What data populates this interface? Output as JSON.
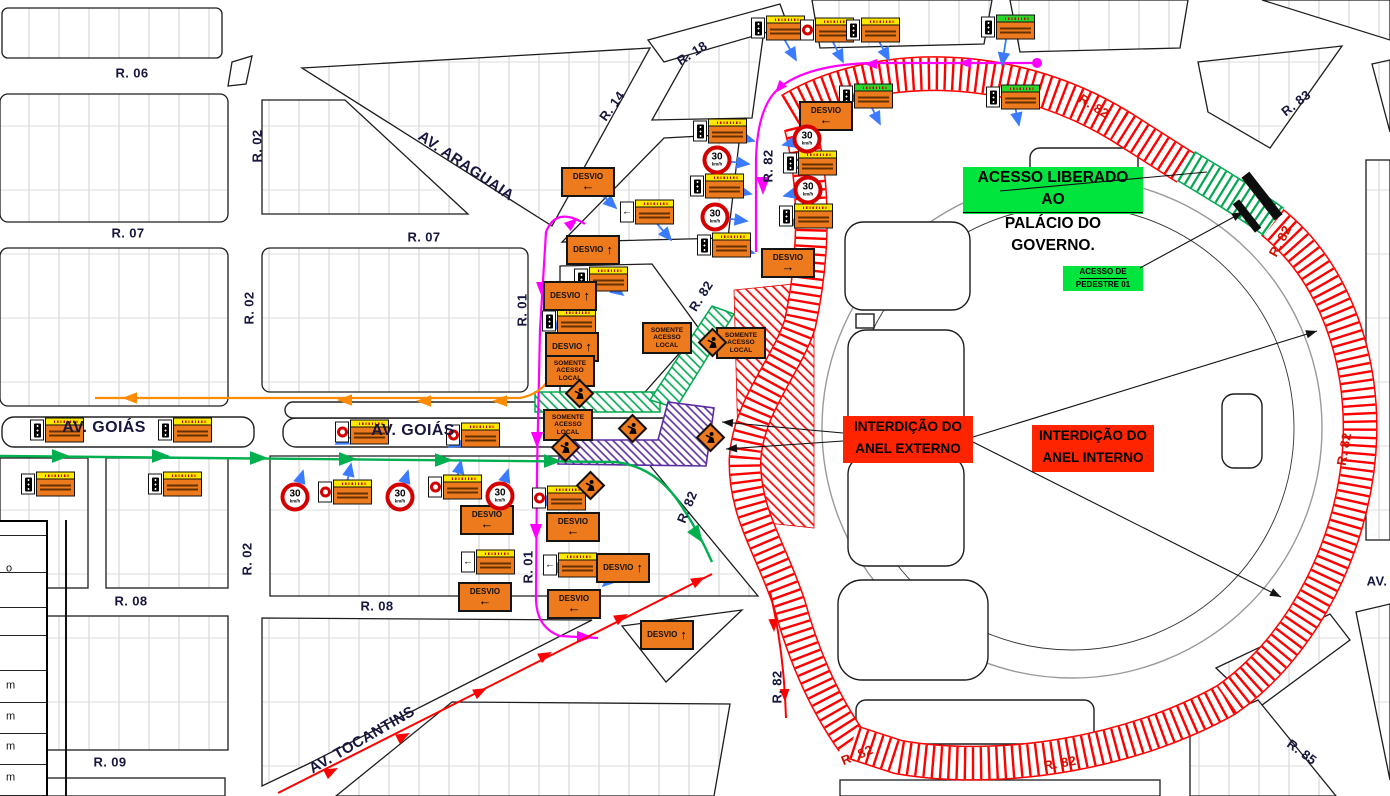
{
  "colors": {
    "closure_red": "#ff2400",
    "hatch_red": "#ff0000",
    "access_green": "#00e53e",
    "hatch_green": "#00a84f",
    "corridor_purple": "#5a2ca0",
    "detour_magenta": "#ff00ff",
    "route_green": "#00b050",
    "route_orange": "#ff8c00",
    "route_red": "#ff0000",
    "leader_blue": "#3b7bff",
    "sign_orange": "#ed7a1c",
    "sign_yellow": "#ffe800",
    "sign_green_header": "#2bd62b",
    "speed_red": "#d40000",
    "label_dark": "#16163f",
    "label_red": "#d01000"
  },
  "callouts": {
    "access_granted": {
      "line1": "ACESSO LIBERADO AO",
      "line2": "PALÁCIO DO GOVERNO."
    },
    "pedestrian_access": {
      "line1": "ACESSO DE",
      "line2": "PEDESTRE 01"
    },
    "outer_ring_closure": {
      "line1": "INTERDIÇÃO DO",
      "line2": "ANEL EXTERNO"
    },
    "inner_ring_closure": {
      "line1": "INTERDIÇÃO DO",
      "line2": "ANEL INTERNO"
    }
  },
  "street_labels": [
    {
      "t": "R. 06",
      "x": 132,
      "y": 73,
      "r": 0
    },
    {
      "t": "R. 02",
      "x": 257,
      "y": 146,
      "r": -90
    },
    {
      "t": "R. 07",
      "x": 128,
      "y": 233,
      "r": 0
    },
    {
      "t": "R. 07",
      "x": 424,
      "y": 237,
      "r": 0
    },
    {
      "t": "AV. ARAGUAIA",
      "x": 466,
      "y": 166,
      "r": 34,
      "s": 15
    },
    {
      "t": "R. 14",
      "x": 612,
      "y": 106,
      "r": -54
    },
    {
      "t": "R. 18",
      "x": 692,
      "y": 53,
      "r": -32
    },
    {
      "t": "R. 82",
      "x": 768,
      "y": 166,
      "r": -90
    },
    {
      "t": "R. 02",
      "x": 249,
      "y": 308,
      "r": -90
    },
    {
      "t": "R. 01",
      "x": 522,
      "y": 310,
      "r": -90
    },
    {
      "t": "AV. GOIÁS",
      "x": 104,
      "y": 428,
      "r": 0,
      "s": 16
    },
    {
      "t": "AV. GOIÁS",
      "x": 413,
      "y": 431,
      "r": 0,
      "s": 16
    },
    {
      "t": "R. 02",
      "x": 247,
      "y": 559,
      "r": -90
    },
    {
      "t": "R. 01",
      "x": 528,
      "y": 567,
      "r": -90
    },
    {
      "t": "R. 82",
      "x": 701,
      "y": 296,
      "r": -58
    },
    {
      "t": "R. 82",
      "x": 687,
      "y": 507,
      "r": -68
    },
    {
      "t": "R. 08",
      "x": 131,
      "y": 601,
      "r": 0
    },
    {
      "t": "R. 08",
      "x": 377,
      "y": 606,
      "r": 0
    },
    {
      "t": "R. 82",
      "x": 777,
      "y": 687,
      "r": -90
    },
    {
      "t": "R. 09",
      "x": 110,
      "y": 762,
      "r": 0
    },
    {
      "t": "AV. TOCANTINS",
      "x": 362,
      "y": 740,
      "r": -30,
      "s": 15
    },
    {
      "t": "R. 83",
      "x": 1296,
      "y": 103,
      "r": -38
    },
    {
      "t": "R. 82",
      "x": 1094,
      "y": 106,
      "r": 32,
      "c": "red"
    },
    {
      "t": "R. 82",
      "x": 1280,
      "y": 241,
      "r": -62,
      "c": "red"
    },
    {
      "t": "R. 82",
      "x": 1344,
      "y": 449,
      "r": -80,
      "c": "red"
    },
    {
      "t": "AV.",
      "x": 1377,
      "y": 581,
      "r": 0
    },
    {
      "t": "R. 82",
      "x": 1060,
      "y": 763,
      "r": -10,
      "c": "red"
    },
    {
      "t": "R. 82",
      "x": 857,
      "y": 755,
      "r": -22,
      "c": "red"
    },
    {
      "t": "R. 85",
      "x": 1302,
      "y": 752,
      "r": 36
    }
  ],
  "signs": {
    "labels": {
      "desvio": "DESVIO",
      "somente": [
        "SOMENTE",
        "ACESSO",
        "LOCAL"
      ],
      "speed": "30",
      "speed_unit": "km/h"
    },
    "items": [
      {
        "t": "atencao",
        "x": 778,
        "y": 28,
        "v": "tl",
        "h": "y",
        "l": [
          18,
          32
        ]
      },
      {
        "t": "atencao",
        "x": 827,
        "y": 30,
        "v": "circle",
        "h": "y",
        "l": [
          16,
          32
        ]
      },
      {
        "t": "atencao",
        "x": 873,
        "y": 30,
        "v": "tl",
        "h": "y",
        "l": [
          16,
          30
        ]
      },
      {
        "t": "atencao",
        "x": 1008,
        "y": 27,
        "v": "tl",
        "h": "g",
        "l": [
          -6,
          38
        ]
      },
      {
        "t": "atencao",
        "x": 1013,
        "y": 97,
        "v": "tl",
        "h": "g",
        "l": [
          6,
          28
        ]
      },
      {
        "t": "atencao",
        "x": 866,
        "y": 96,
        "v": "tl",
        "h": "g",
        "l": [
          14,
          28
        ]
      },
      {
        "t": "atencao",
        "x": 720,
        "y": 131,
        "v": "tl",
        "h": "y",
        "l": [
          34,
          10
        ]
      },
      {
        "t": "atencao",
        "x": 717,
        "y": 186,
        "v": "tl",
        "h": "y",
        "l": [
          34,
          8
        ]
      },
      {
        "t": "atencao",
        "x": 724,
        "y": 245,
        "v": "tl",
        "h": "y",
        "l": [
          30,
          8
        ]
      },
      {
        "t": "atencao",
        "x": 810,
        "y": 163,
        "v": "tl",
        "h": "y",
        "l": [
          -26,
          8
        ]
      },
      {
        "t": "atencao",
        "x": 806,
        "y": 216,
        "v": "tl",
        "h": "y",
        "l": [
          -24,
          8
        ]
      },
      {
        "t": "atencao",
        "x": 647,
        "y": 212,
        "v": "arrow",
        "h": "y",
        "l": [
          24,
          28
        ]
      },
      {
        "t": "atencao",
        "x": 601,
        "y": 279,
        "v": "tl",
        "h": "y",
        "l": [
          22,
          16
        ]
      },
      {
        "t": "atencao",
        "x": 569,
        "y": 321,
        "v": "tl",
        "h": "y",
        "l": [
          -24,
          6
        ]
      },
      {
        "t": "atencao",
        "x": 559,
        "y": 498,
        "v": "circle",
        "h": "y",
        "l": [
          -22,
          6
        ]
      },
      {
        "t": "atencao",
        "x": 570,
        "y": 565,
        "v": "arrow",
        "h": "y",
        "l": [
          -22,
          6
        ]
      },
      {
        "t": "atencao",
        "x": 488,
        "y": 562,
        "v": "arrow",
        "h": "y",
        "l": [
          24,
          -6
        ]
      },
      {
        "t": "atencao",
        "x": 362,
        "y": 432,
        "v": "circle",
        "h": "y",
        "l": [
          -26,
          12
        ]
      },
      {
        "t": "atencao",
        "x": 473,
        "y": 435,
        "v": "circle",
        "h": "y",
        "l": [
          -24,
          12
        ]
      },
      {
        "t": "atencao",
        "x": 345,
        "y": 492,
        "v": "circle",
        "h": "y",
        "l": [
          6,
          -28
        ]
      },
      {
        "t": "atencao",
        "x": 455,
        "y": 487,
        "v": "circle",
        "h": "y",
        "l": [
          6,
          -26
        ]
      },
      {
        "t": "atencao",
        "x": 57,
        "y": 430,
        "v": "tl",
        "h": "y",
        "l": [
          20,
          6
        ]
      },
      {
        "t": "atencao",
        "x": 185,
        "y": 430,
        "v": "tl",
        "h": "y",
        "l": [
          20,
          6
        ]
      },
      {
        "t": "atencao",
        "x": 48,
        "y": 484,
        "v": "tl",
        "h": "y",
        "l": [
          18,
          -5
        ]
      },
      {
        "t": "atencao",
        "x": 175,
        "y": 484,
        "v": "tl",
        "h": "y",
        "l": [
          18,
          -5
        ]
      },
      {
        "t": "desvio",
        "x": 588,
        "y": 182,
        "a": "left",
        "l": [
          28,
          26
        ]
      },
      {
        "t": "desvio",
        "x": 826,
        "y": 116,
        "a": "left",
        "l": [
          -18,
          28
        ]
      },
      {
        "t": "desvio",
        "x": 788,
        "y": 263,
        "a": "right",
        "l": [
          -24,
          6
        ]
      },
      {
        "t": "desvio",
        "x": 593,
        "y": 250,
        "a": "up",
        "l": [
          24,
          14
        ]
      },
      {
        "t": "desvio",
        "x": 570,
        "y": 296,
        "a": "up",
        "l": [
          -24,
          6
        ]
      },
      {
        "t": "desvio",
        "x": 572,
        "y": 347,
        "a": "up",
        "l": [
          -24,
          6
        ]
      },
      {
        "t": "desvio",
        "x": 623,
        "y": 568,
        "a": "up",
        "l": [
          -20,
          18
        ]
      },
      {
        "t": "desvio",
        "x": 573,
        "y": 527,
        "a": "left",
        "l": [
          -24,
          6
        ]
      },
      {
        "t": "desvio",
        "x": 574,
        "y": 604,
        "a": "left",
        "l": [
          -24,
          6
        ]
      },
      {
        "t": "desvio",
        "x": 667,
        "y": 635,
        "a": "up",
        "l": [
          -24,
          14
        ]
      },
      {
        "t": "desvio",
        "x": 487,
        "y": 520,
        "a": "left",
        "l": [
          24,
          -4
        ]
      },
      {
        "t": "desvio",
        "x": 485,
        "y": 597,
        "a": "left",
        "l": [
          24,
          -4
        ]
      },
      {
        "t": "somente",
        "x": 570,
        "y": 371,
        "l": [
          -24,
          6
        ]
      },
      {
        "t": "somente",
        "x": 568,
        "y": 425,
        "l": [
          -24,
          6
        ]
      },
      {
        "t": "somente",
        "x": 667,
        "y": 338,
        "l": [
          22,
          -8
        ]
      },
      {
        "t": "somente",
        "x": 741,
        "y": 343,
        "l": [
          -20,
          6
        ]
      },
      {
        "t": "diamond",
        "x": 579,
        "y": 393
      },
      {
        "t": "diamond",
        "x": 632,
        "y": 428
      },
      {
        "t": "diamond",
        "x": 710,
        "y": 437
      },
      {
        "t": "diamond",
        "x": 590,
        "y": 485
      },
      {
        "t": "diamond",
        "x": 565,
        "y": 447
      },
      {
        "t": "diamond",
        "x": 712,
        "y": 342
      },
      {
        "t": "speed",
        "x": 717,
        "y": 160,
        "l": [
          32,
          4
        ]
      },
      {
        "t": "speed",
        "x": 715,
        "y": 217,
        "l": [
          32,
          4
        ]
      },
      {
        "t": "speed",
        "x": 807,
        "y": 139,
        "l": [
          -24,
          6
        ]
      },
      {
        "t": "speed",
        "x": 808,
        "y": 190,
        "l": [
          -24,
          6
        ]
      },
      {
        "t": "speed",
        "x": 295,
        "y": 497,
        "l": [
          8,
          -26
        ]
      },
      {
        "t": "speed",
        "x": 400,
        "y": 497,
        "l": [
          8,
          -26
        ]
      },
      {
        "t": "speed",
        "x": 500,
        "y": 496,
        "l": [
          8,
          -26
        ]
      }
    ]
  },
  "legend": {
    "row_lines": [
      533,
      570,
      605,
      633,
      668,
      700,
      731,
      762,
      793
    ],
    "edge_letters": [
      {
        "t": "o",
        "y": 567
      },
      {
        "t": "m",
        "y": 684
      },
      {
        "t": "m",
        "y": 715
      },
      {
        "t": "m",
        "y": 745
      },
      {
        "t": "m",
        "y": 776
      }
    ]
  }
}
